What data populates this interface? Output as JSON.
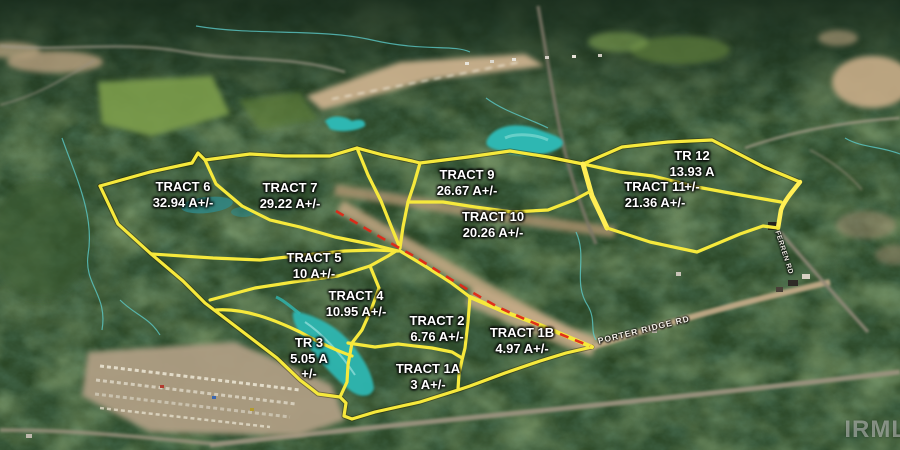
{
  "map": {
    "watermark": "IRML",
    "colors": {
      "boundary_yellow": "#f6e93c",
      "road_dash_red": "#df2817",
      "water_teal": "#2fb7b2"
    },
    "roads": [
      {
        "label": "PORTER RIDGE RD"
      },
      {
        "label": "FERREN RD"
      }
    ],
    "tracts": [
      {
        "name": "TRACT 6",
        "line2": "32.94 A+/-",
        "line3": ""
      },
      {
        "name": "TRACT 7",
        "line2": "29.22 A+/-",
        "line3": ""
      },
      {
        "name": "TRACT 9",
        "line2": "26.67 A+/-",
        "line3": ""
      },
      {
        "name": "TRACT 10",
        "line2": "20.26 A+/-",
        "line3": ""
      },
      {
        "name": "TRACT 11",
        "line2": "21.36 A+/-",
        "line3": ""
      },
      {
        "name": "TR 12",
        "line2": "13.93 A",
        "line3": "+/-"
      },
      {
        "name": "TRACT 5",
        "line2": "10 A+/-",
        "line3": ""
      },
      {
        "name": "TRACT 4",
        "line2": "10.95 A+/-",
        "line3": ""
      },
      {
        "name": "TRACT 2",
        "line2": "6.76 A+/-",
        "line3": ""
      },
      {
        "name": "TRACT 1B",
        "line2": "4.97 A+/-",
        "line3": ""
      },
      {
        "name": "TR 3",
        "line2": "5.05 A",
        "line3": "+/-"
      },
      {
        "name": "TRACT 1A",
        "line2": "3 A+/-",
        "line3": ""
      }
    ]
  }
}
